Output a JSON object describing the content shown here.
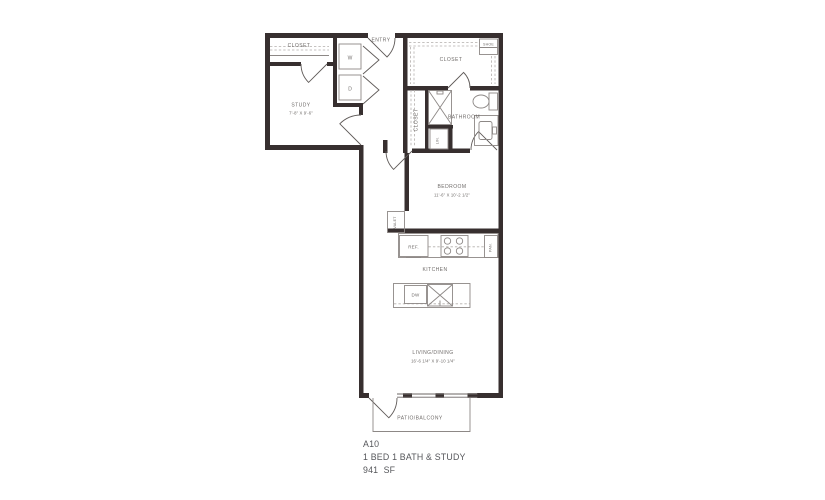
{
  "plan": {
    "rooms": {
      "study": {
        "label": "STUDY",
        "dims": "7'-8\" X 9'-6\""
      },
      "study_closet": {
        "label": "CLOSET"
      },
      "entry": {
        "label": "ENTRY"
      },
      "walkin_closet": {
        "label": "CLOSET"
      },
      "shoe": {
        "label": "SHOE"
      },
      "hall_closet": {
        "label": "CLOSET"
      },
      "bathroom": {
        "label": "BATHROOM"
      },
      "linen": {
        "label": "LIN."
      },
      "bedroom": {
        "label": "BEDROOM",
        "dims": "11'-6\" X 10'-2 1/2\""
      },
      "valet": {
        "label": "VALET"
      },
      "kitchen": {
        "label": "KITCHEN"
      },
      "living_dining": {
        "label": "LIVING/DINING",
        "dims": "16'-6 1/4\" X 9'-10 1/4\""
      },
      "patio": {
        "label": "PATIO/BALCONY"
      }
    },
    "appliances": {
      "washer": "W",
      "dryer": "D",
      "refrigerator": "REF.",
      "pantry": "PAN.",
      "dishwasher": "DW"
    },
    "title": {
      "unit": "A10",
      "description": "1 BED 1 BATH & STUDY",
      "area": "941  SF"
    },
    "colors": {
      "wall": "#372f2f",
      "fixture": "#8d8886",
      "dashed": "#b3afac",
      "label": "#6f6b69",
      "title_text": "#55565a"
    }
  }
}
